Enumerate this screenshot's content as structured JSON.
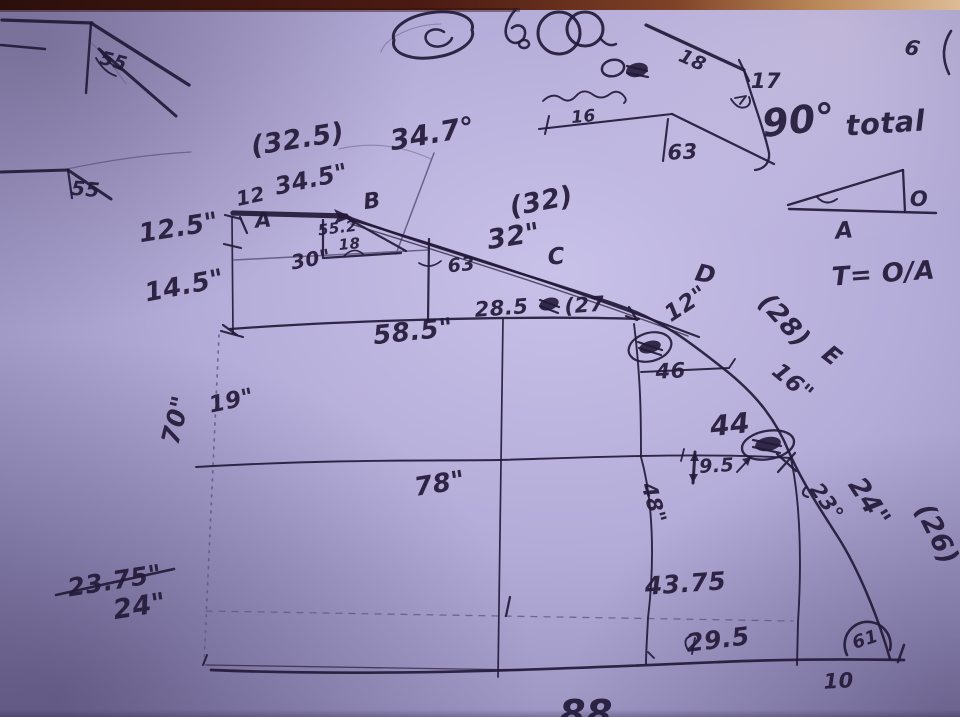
{
  "description": "photo of a hand-drawn measurement sketch of a large curved (quarter-arc) part with station lines and dimensions",
  "colors": {
    "ink": "#231a38",
    "pencil": "#5f5881",
    "paper_center": "#c8c1e8",
    "paper_edge": "#837ca8",
    "table_dark": "#2c0f0b",
    "table_light": "#ddbb95"
  },
  "labels": [
    {
      "id": "tl-angle-55a",
      "text": "55",
      "x": 112,
      "y": 67,
      "rot": 15,
      "size": 19
    },
    {
      "id": "tl-angle-55b",
      "text": "55",
      "x": 85,
      "y": 196,
      "rot": 5,
      "size": 20
    },
    {
      "id": "paren-32-5",
      "text": "(32.5)",
      "x": 299,
      "y": 148,
      "rot": -9,
      "size": 27
    },
    {
      "id": "angle-34-7",
      "text": "34.7°",
      "x": 434,
      "y": 143,
      "rot": -10,
      "size": 28
    },
    {
      "id": "dim-34-5",
      "text": "34.5\"",
      "x": 313,
      "y": 187,
      "rot": -12,
      "size": 24
    },
    {
      "id": "len-12",
      "text": "12",
      "x": 252,
      "y": 203,
      "rot": -12,
      "size": 20
    },
    {
      "id": "point-A",
      "text": "A",
      "x": 264,
      "y": 227,
      "rot": -5,
      "size": 21
    },
    {
      "id": "point-B",
      "text": "B",
      "x": 373,
      "y": 208,
      "rot": -8,
      "size": 22
    },
    {
      "id": "dim-55-2",
      "text": "55.2",
      "x": 338,
      "y": 233,
      "rot": -7,
      "size": 15
    },
    {
      "id": "dim-18",
      "text": "18",
      "x": 350,
      "y": 249,
      "rot": -5,
      "size": 15
    },
    {
      "id": "dim-30",
      "text": "30\"",
      "x": 312,
      "y": 266,
      "rot": -10,
      "size": 20
    },
    {
      "id": "dim-12-5",
      "text": "12.5\"",
      "x": 180,
      "y": 236,
      "rot": -9,
      "size": 26
    },
    {
      "id": "dim-14-5",
      "text": "14.5\"",
      "x": 186,
      "y": 294,
      "rot": -11,
      "size": 26
    },
    {
      "id": "paren-32",
      "text": "(32)",
      "x": 543,
      "y": 210,
      "rot": -11,
      "size": 27
    },
    {
      "id": "dim-32",
      "text": "32\"",
      "x": 515,
      "y": 245,
      "rot": -9,
      "size": 27
    },
    {
      "id": "point-C",
      "text": "C",
      "x": 557,
      "y": 264,
      "rot": -5,
      "size": 23
    },
    {
      "id": "angle-63",
      "text": "63",
      "x": 462,
      "y": 271,
      "rot": -6,
      "size": 19
    },
    {
      "id": "dim-28-5",
      "text": "28.5",
      "x": 502,
      "y": 315,
      "rot": -4,
      "size": 21
    },
    {
      "id": "paren-27",
      "text": "(27",
      "x": 585,
      "y": 312,
      "rot": -4,
      "size": 21
    },
    {
      "id": "dim-58-5",
      "text": "58.5\"",
      "x": 414,
      "y": 340,
      "rot": -6,
      "size": 26
    },
    {
      "id": "point-D",
      "text": "D",
      "x": 704,
      "y": 282,
      "rot": 12,
      "size": 24
    },
    {
      "id": "dim-12in",
      "text": "12\"",
      "x": 690,
      "y": 310,
      "rot": -33,
      "size": 23
    },
    {
      "id": "paren-28",
      "text": "(28)",
      "x": 778,
      "y": 326,
      "rot": 48,
      "size": 26
    },
    {
      "id": "point-E",
      "text": "E",
      "x": 827,
      "y": 362,
      "rot": 38,
      "size": 24
    },
    {
      "id": "dim-16in",
      "text": "16\"",
      "x": 788,
      "y": 388,
      "rot": 40,
      "size": 23
    },
    {
      "id": "dim-46",
      "text": "46",
      "x": 671,
      "y": 378,
      "rot": -3,
      "size": 21
    },
    {
      "id": "dim-44",
      "text": "44",
      "x": 731,
      "y": 434,
      "rot": -6,
      "size": 28
    },
    {
      "id": "dim-9-5",
      "text": "9.5",
      "x": 717,
      "y": 472,
      "rot": -3,
      "size": 19
    },
    {
      "id": "angle-23",
      "text": "23°",
      "x": 821,
      "y": 506,
      "rot": 54,
      "size": 21
    },
    {
      "id": "dim-24in",
      "text": "24\"",
      "x": 862,
      "y": 507,
      "rot": 57,
      "size": 27
    },
    {
      "id": "paren-26",
      "text": "(26)",
      "x": 929,
      "y": 538,
      "rot": 64,
      "size": 27
    },
    {
      "id": "dim-48",
      "text": "48\"",
      "x": 647,
      "y": 505,
      "rot": 74,
      "size": 21
    },
    {
      "id": "dim-19",
      "text": "19\"",
      "x": 233,
      "y": 408,
      "rot": -12,
      "size": 23
    },
    {
      "id": "dim-70",
      "text": "70\"",
      "x": 184,
      "y": 422,
      "rot": -76,
      "size": 25
    },
    {
      "id": "dim-78",
      "text": "78\"",
      "x": 441,
      "y": 492,
      "rot": -9,
      "size": 26
    },
    {
      "id": "dim-43-75",
      "text": "43.75",
      "x": 686,
      "y": 592,
      "rot": -4,
      "size": 25
    },
    {
      "id": "dim-29-5",
      "text": "29.5",
      "x": 719,
      "y": 648,
      "rot": -7,
      "size": 25
    },
    {
      "id": "dim-10",
      "text": "10",
      "x": 839,
      "y": 688,
      "rot": -3,
      "size": 21
    },
    {
      "id": "angle-61",
      "text": "61",
      "x": 867,
      "y": 645,
      "rot": -18,
      "size": 18
    },
    {
      "id": "strike-23-75",
      "text": "23.75\"",
      "x": 116,
      "y": 589,
      "rot": -9,
      "size": 25
    },
    {
      "id": "dim-24b",
      "text": "24\"",
      "x": 141,
      "y": 615,
      "rot": -9,
      "size": 27
    },
    {
      "id": "dim-88",
      "text": "88",
      "x": 586,
      "y": 727,
      "rot": 0,
      "size": 38
    },
    {
      "id": "tr-17",
      "text": "17",
      "x": 766,
      "y": 88,
      "rot": 0,
      "size": 21
    },
    {
      "id": "tr-18",
      "text": "18",
      "x": 690,
      "y": 66,
      "rot": 24,
      "size": 19
    },
    {
      "id": "tr-90deg",
      "text": "90°",
      "x": 800,
      "y": 133,
      "rot": -6,
      "size": 38
    },
    {
      "id": "tr-total",
      "text": "total",
      "x": 886,
      "y": 133,
      "rot": -4,
      "size": 29
    },
    {
      "id": "tr-16",
      "text": "16",
      "x": 584,
      "y": 122,
      "rot": -5,
      "size": 17
    },
    {
      "id": "tr-63",
      "text": "63",
      "x": 683,
      "y": 159,
      "rot": -3,
      "size": 21
    },
    {
      "id": "tri-O",
      "text": "O",
      "x": 919,
      "y": 206,
      "rot": 0,
      "size": 21
    },
    {
      "id": "tri-A",
      "text": "A",
      "x": 845,
      "y": 238,
      "rot": -5,
      "size": 23
    },
    {
      "id": "formula-T-OA",
      "text": "T= O/A",
      "x": 884,
      "y": 282,
      "rot": -4,
      "size": 26
    },
    {
      "id": "tr-6doodle",
      "text": "6",
      "x": 911,
      "y": 55,
      "rot": 12,
      "size": 21
    }
  ]
}
